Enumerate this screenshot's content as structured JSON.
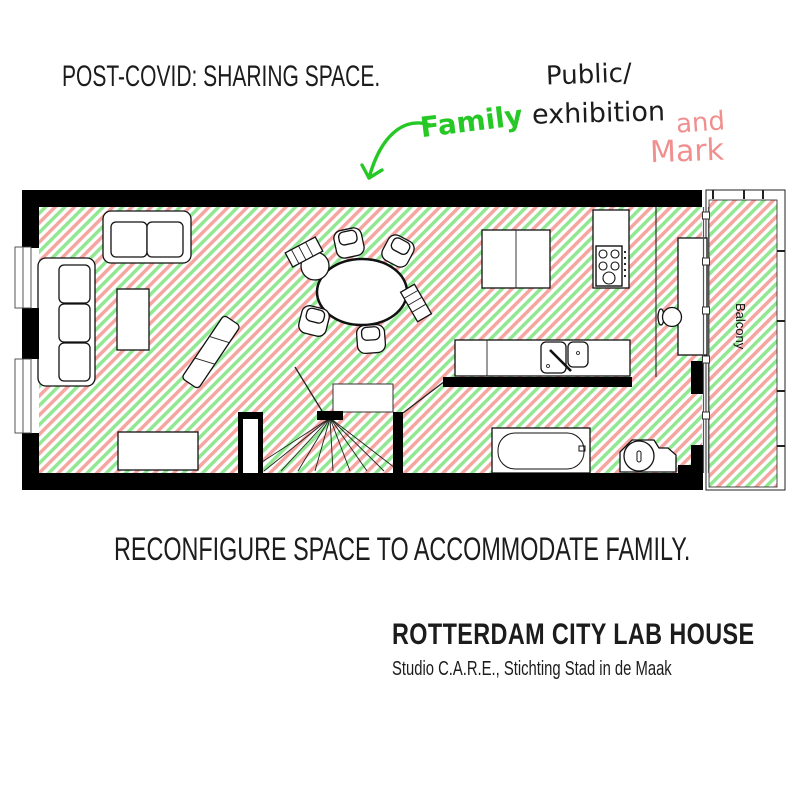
{
  "texts": {
    "headline": "POST-COVID: SHARING SPACE.",
    "caption": "RECONFIGURE SPACE TO ACCOMMODATE FAMILY.",
    "project_title": "ROTTERDAM CITY LAB HOUSE",
    "credits": "Studio C.A.R.E., Stichting Stad in de Maak"
  },
  "annotations": {
    "family": "Family",
    "public_line1": "Public/",
    "public_line2": "exhibition",
    "and_word": "and",
    "mark_word": "Mark"
  },
  "floorplan": {
    "balcony_label": "Balcony"
  },
  "colors": {
    "annotation_green": "#26c826",
    "annotation_pink": "#f18f8f",
    "hatch_green": "#92e892",
    "hatch_pink": "#f6a6a1",
    "wall_black": "#000000",
    "text_black": "#1c1c1c"
  }
}
